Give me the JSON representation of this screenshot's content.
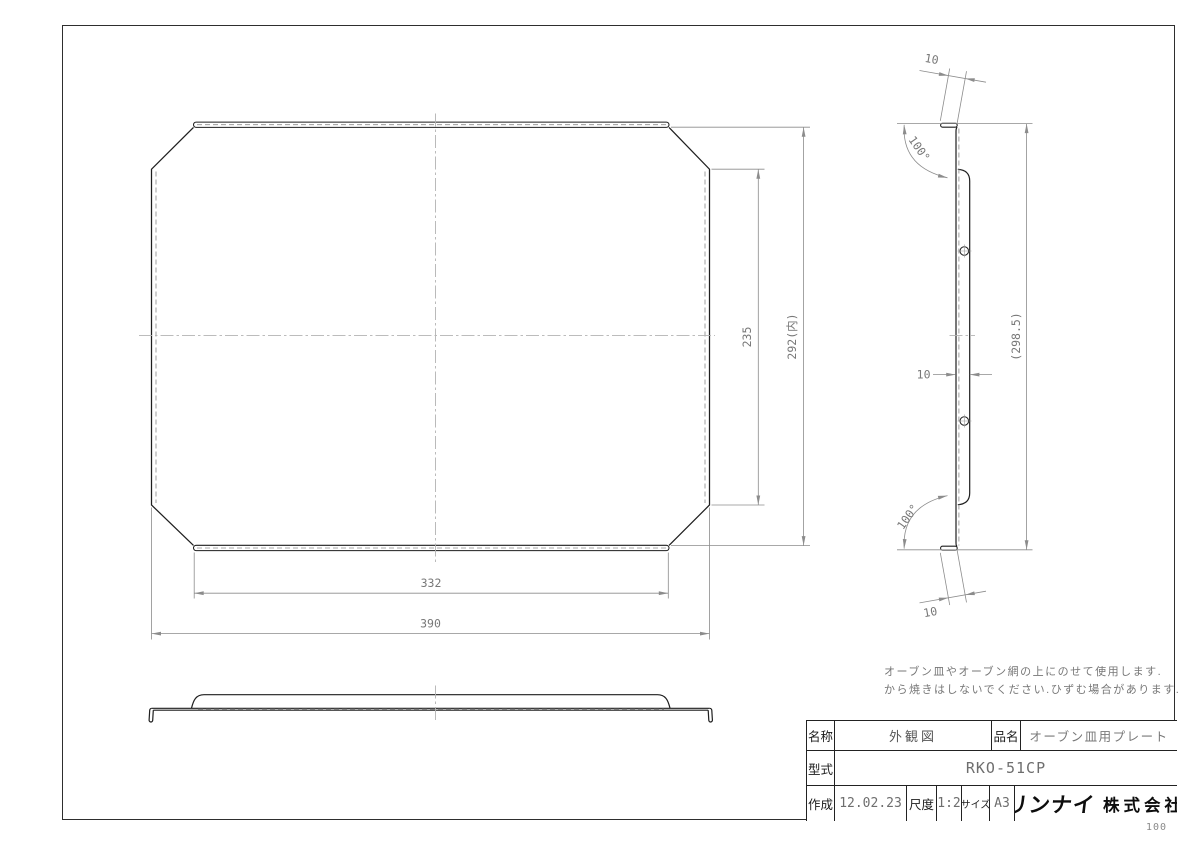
{
  "frame": {
    "page_number": "100"
  },
  "notes": {
    "line1": "オーブン皿やオーブン網の上にのせて使用します.",
    "line2": "から焼きはしないでください.ひずむ場合があります."
  },
  "dims": {
    "plan_inner_h": "235",
    "plan_outer_h": "292(内)",
    "plan_inner_w": "332",
    "plan_outer_w": "390",
    "side_overall": "(298.5)",
    "side_depth": "10",
    "side_flange_top": "10",
    "side_flange_bottom": "10",
    "side_angle_top": "100°",
    "side_angle_bottom": "100°"
  },
  "title_block": {
    "name_label": "名称",
    "name_value": "外観図",
    "product_label": "品名",
    "product_value": "オーブン皿用プレート",
    "model_label": "型式",
    "model_value": "RKO-51CP",
    "created_label": "作成",
    "created_value": "12.02.23",
    "scale_label": "尺度",
    "scale_value": "1:2",
    "size_label": "サイズ",
    "size_value": "A3",
    "company_logo": "リンナイ",
    "company_suffix": "株式会社"
  }
}
